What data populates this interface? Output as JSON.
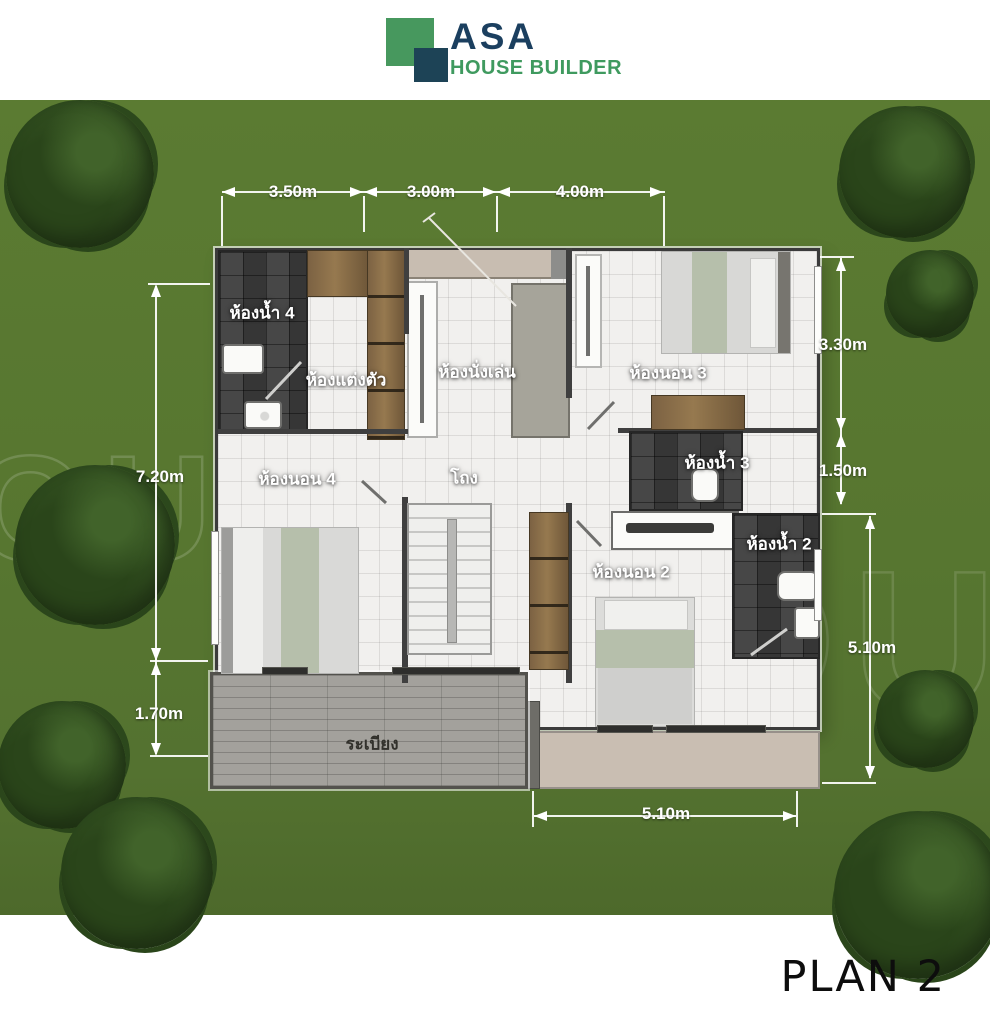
{
  "header": {
    "brand_abbr": "ASA",
    "brand_name": "HOUSE BUILDER"
  },
  "watermark": {
    "text": "HOUSE"
  },
  "plan": {
    "rooms": {
      "bathroom4": "ห้องน้ำ 4",
      "dressing": "ห้องแต่งตัว",
      "living": "ห้องนั่งเล่น",
      "bedroom3": "ห้องนอน 3",
      "bedroom4": "ห้องนอน 4",
      "hall": "โถง",
      "bathroom3": "ห้องน้ำ 3",
      "bathroom2": "ห้องน้ำ 2",
      "bedroom2": "ห้องนอน 2",
      "balcony": "ระเบียง"
    },
    "dimensions": {
      "top": [
        "3.50m",
        "3.00m",
        "4.00m"
      ],
      "left": [
        "7.20m",
        "1.70m"
      ],
      "right": [
        "3.30m",
        "1.50m",
        "5.10m"
      ],
      "bottom": [
        "5.10m"
      ]
    }
  },
  "footer": {
    "plan_label": "PLAN 2"
  },
  "colors": {
    "brand_green": "#3f9a5f",
    "brand_navy": "#1b3f5f",
    "grass": "#567630",
    "floor_light": "#f1f0ee",
    "tile_dark": "#3d3d3d",
    "balcony_gray": "#a3a19c",
    "wood": "#8a6f4d",
    "bedding_sage": "#b6bfab"
  }
}
